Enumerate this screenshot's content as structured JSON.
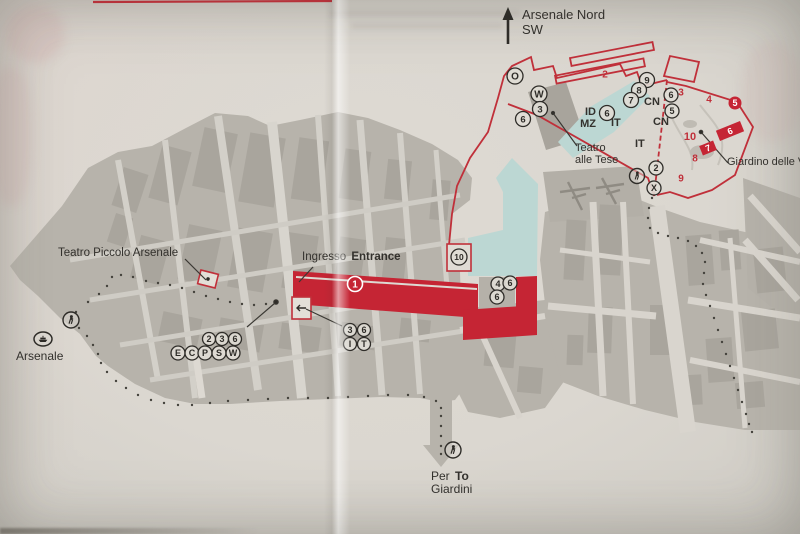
{
  "map_title": "Arsenale area visitor map",
  "labels": {
    "compass1": "Arsenale Nord",
    "compass2": "SW",
    "teatro_piccolo": "Teatro Piccolo Arsenale",
    "ingresso": "Ingresso",
    "entrance": "Entrance",
    "tese1": "Teatro",
    "tese2": "alle Tese",
    "giardino": "Giardino delle Ve",
    "arsenale": "Arsenale",
    "per": "Per",
    "to": "To",
    "giardini": "Giardini",
    "id": "ID",
    "mz": "MZ",
    "it1": "IT",
    "it2": "IT",
    "cn1": "CN",
    "cn2": "CN"
  },
  "colors": {
    "red": "#c0303a",
    "red_fill": "#c5onwards2534",
    "cyan": "#bcd7d3",
    "gray": "#b7b3ab",
    "paper": "#dcd8d1",
    "ink": "#2e2c28"
  },
  "markers": [
    {
      "k": "circle",
      "x": 515,
      "y": 76,
      "r": 8,
      "t": "O"
    },
    {
      "k": "circle",
      "x": 539,
      "y": 94,
      "r": 8,
      "t": "W"
    },
    {
      "k": "circle",
      "x": 540,
      "y": 109,
      "r": 7.5,
      "t": "3"
    },
    {
      "k": "circle",
      "x": 523,
      "y": 119,
      "r": 7.5,
      "t": "6"
    },
    {
      "k": "circle",
      "x": 607,
      "y": 113,
      "r": 7.5,
      "t": "6"
    },
    {
      "k": "circle",
      "x": 647,
      "y": 80,
      "r": 7.5,
      "t": "9"
    },
    {
      "k": "circle",
      "x": 639,
      "y": 90,
      "r": 7.5,
      "t": "8"
    },
    {
      "k": "circle",
      "x": 631,
      "y": 100,
      "r": 7.5,
      "t": "7"
    },
    {
      "k": "circle",
      "x": 671,
      "y": 95,
      "r": 7,
      "t": "6"
    },
    {
      "k": "circle",
      "x": 672,
      "y": 111,
      "r": 7,
      "t": "5"
    },
    {
      "k": "circle",
      "x": 656,
      "y": 168,
      "r": 7,
      "t": "2"
    },
    {
      "k": "circle",
      "x": 654,
      "y": 188,
      "r": 7,
      "t": "X"
    },
    {
      "k": "circle",
      "x": 459,
      "y": 257,
      "r": 8,
      "t": "10"
    },
    {
      "k": "circle",
      "x": 498,
      "y": 284,
      "r": 7,
      "t": "4"
    },
    {
      "k": "circle",
      "x": 510,
      "y": 283,
      "r": 7,
      "t": "6"
    },
    {
      "k": "circle",
      "x": 497,
      "y": 297,
      "r": 7,
      "t": "6"
    },
    {
      "k": "circle",
      "x": 209,
      "y": 339,
      "r": 6.5,
      "t": "2"
    },
    {
      "k": "circle",
      "x": 222,
      "y": 339,
      "r": 6.5,
      "t": "3"
    },
    {
      "k": "circle",
      "x": 235,
      "y": 339,
      "r": 6.5,
      "t": "6"
    },
    {
      "k": "circle",
      "x": 178,
      "y": 353,
      "r": 7,
      "t": "E"
    },
    {
      "k": "circle",
      "x": 192,
      "y": 353,
      "r": 7,
      "t": "C"
    },
    {
      "k": "circle",
      "x": 205,
      "y": 353,
      "r": 7,
      "t": "P"
    },
    {
      "k": "circle",
      "x": 219,
      "y": 353,
      "r": 7,
      "t": "S"
    },
    {
      "k": "circle",
      "x": 233,
      "y": 353,
      "r": 7,
      "t": "W"
    },
    {
      "k": "circle",
      "x": 350,
      "y": 330,
      "r": 6.5,
      "t": "3"
    },
    {
      "k": "circle",
      "x": 364,
      "y": 330,
      "r": 6.5,
      "t": "6"
    },
    {
      "k": "circle",
      "x": 350,
      "y": 344,
      "r": 6.5,
      "t": "I"
    },
    {
      "k": "circle",
      "x": 364,
      "y": 344,
      "r": 6.5,
      "t": "T"
    },
    {
      "k": "entry",
      "x": 355,
      "y": 284,
      "r": 7.5,
      "t": "1"
    },
    {
      "k": "walk",
      "x": 71,
      "y": 320,
      "r": 8
    },
    {
      "k": "walk",
      "x": 637,
      "y": 176,
      "r": 7.5
    },
    {
      "k": "walk",
      "x": 453,
      "y": 450,
      "r": 8
    },
    {
      "k": "boat",
      "x": 43,
      "y": 339,
      "r": 8
    },
    {
      "k": "redtext",
      "x": 605,
      "y": 74,
      "t": "2",
      "s": 10
    },
    {
      "k": "redtext",
      "x": 681,
      "y": 92,
      "t": "3",
      "s": 10
    },
    {
      "k": "redtext",
      "x": 709,
      "y": 99,
      "t": "4",
      "s": 10
    },
    {
      "k": "redtext",
      "x": 690,
      "y": 136,
      "t": "10",
      "s": 11
    },
    {
      "k": "redtext",
      "x": 695,
      "y": 158,
      "t": "8",
      "s": 10
    },
    {
      "k": "redtext",
      "x": 681,
      "y": 178,
      "t": "9",
      "s": 10
    },
    {
      "k": "redcircle",
      "x": 735,
      "y": 103,
      "r": 6.5,
      "t": "5"
    },
    {
      "k": "redbar",
      "x": 730,
      "y": 131,
      "w": 26,
      "h": 11,
      "rot": -22,
      "t": "6"
    },
    {
      "k": "redbar",
      "x": 708,
      "y": 148,
      "w": 15,
      "h": 10,
      "rot": -22,
      "t": "7"
    }
  ]
}
